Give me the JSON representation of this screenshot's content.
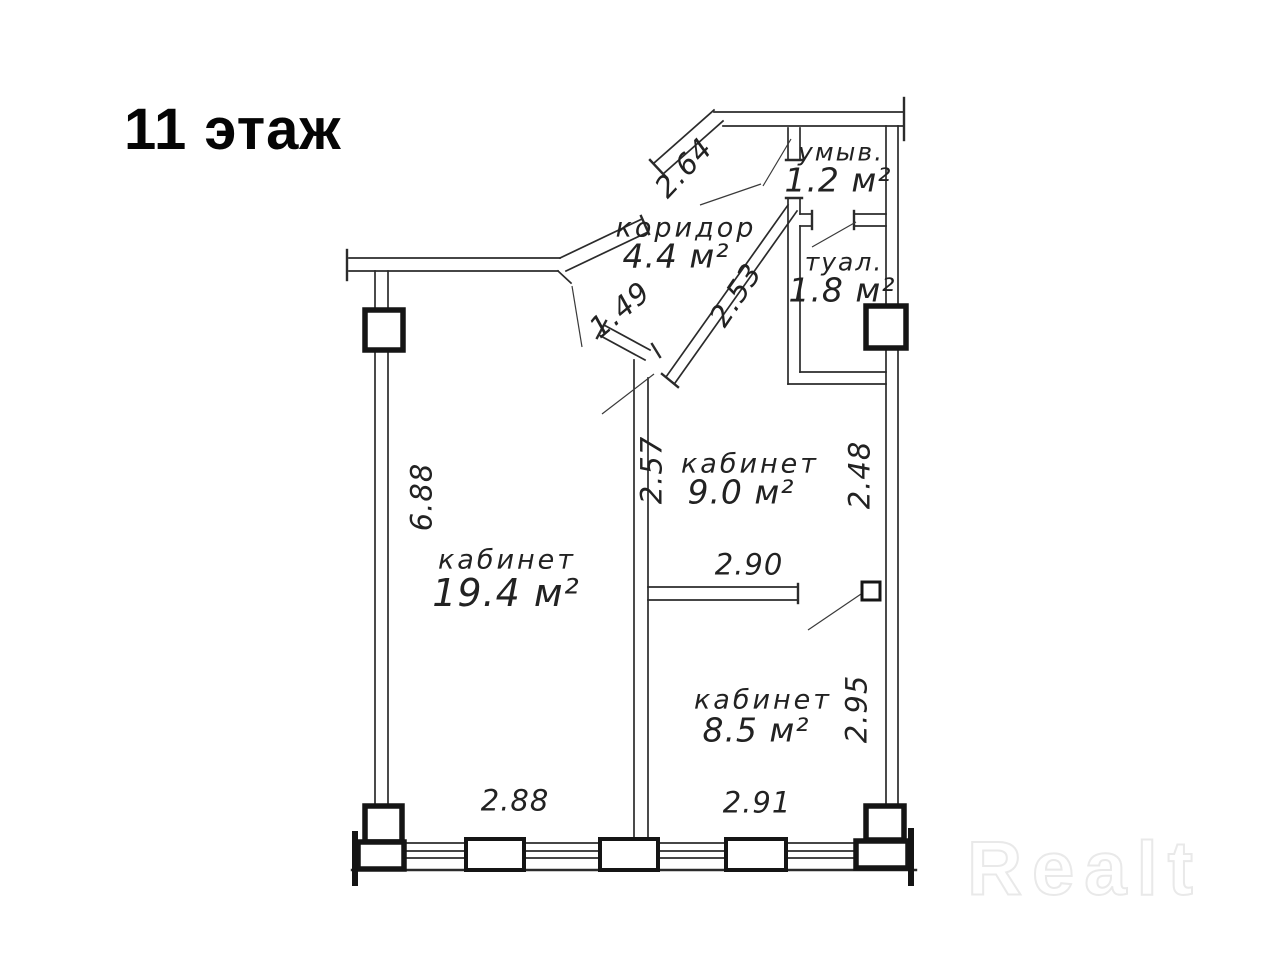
{
  "title": "11 этаж",
  "watermark": "Realt",
  "rooms": {
    "koridor": {
      "name": "коридор",
      "area": "4.4 м²"
    },
    "umyv": {
      "name": "умыв.",
      "area": "1.2 м²"
    },
    "tual": {
      "name": "туал.",
      "area": "1.8 м²"
    },
    "kabinet9": {
      "name": "кабинет",
      "area": "9.0 м²"
    },
    "kabinet19": {
      "name": "кабинет",
      "area": "19.4 м²"
    },
    "kabinet8": {
      "name": "кабинет",
      "area": "8.5 м²"
    }
  },
  "dimensions": {
    "d264": "2.64",
    "d149": "1.49",
    "d253": "2.53",
    "d257": "2.57",
    "d248": "2.48",
    "d688": "6.88",
    "d290": "2.90",
    "d295": "2.95",
    "d288": "2.88",
    "d291": "2.91"
  }
}
